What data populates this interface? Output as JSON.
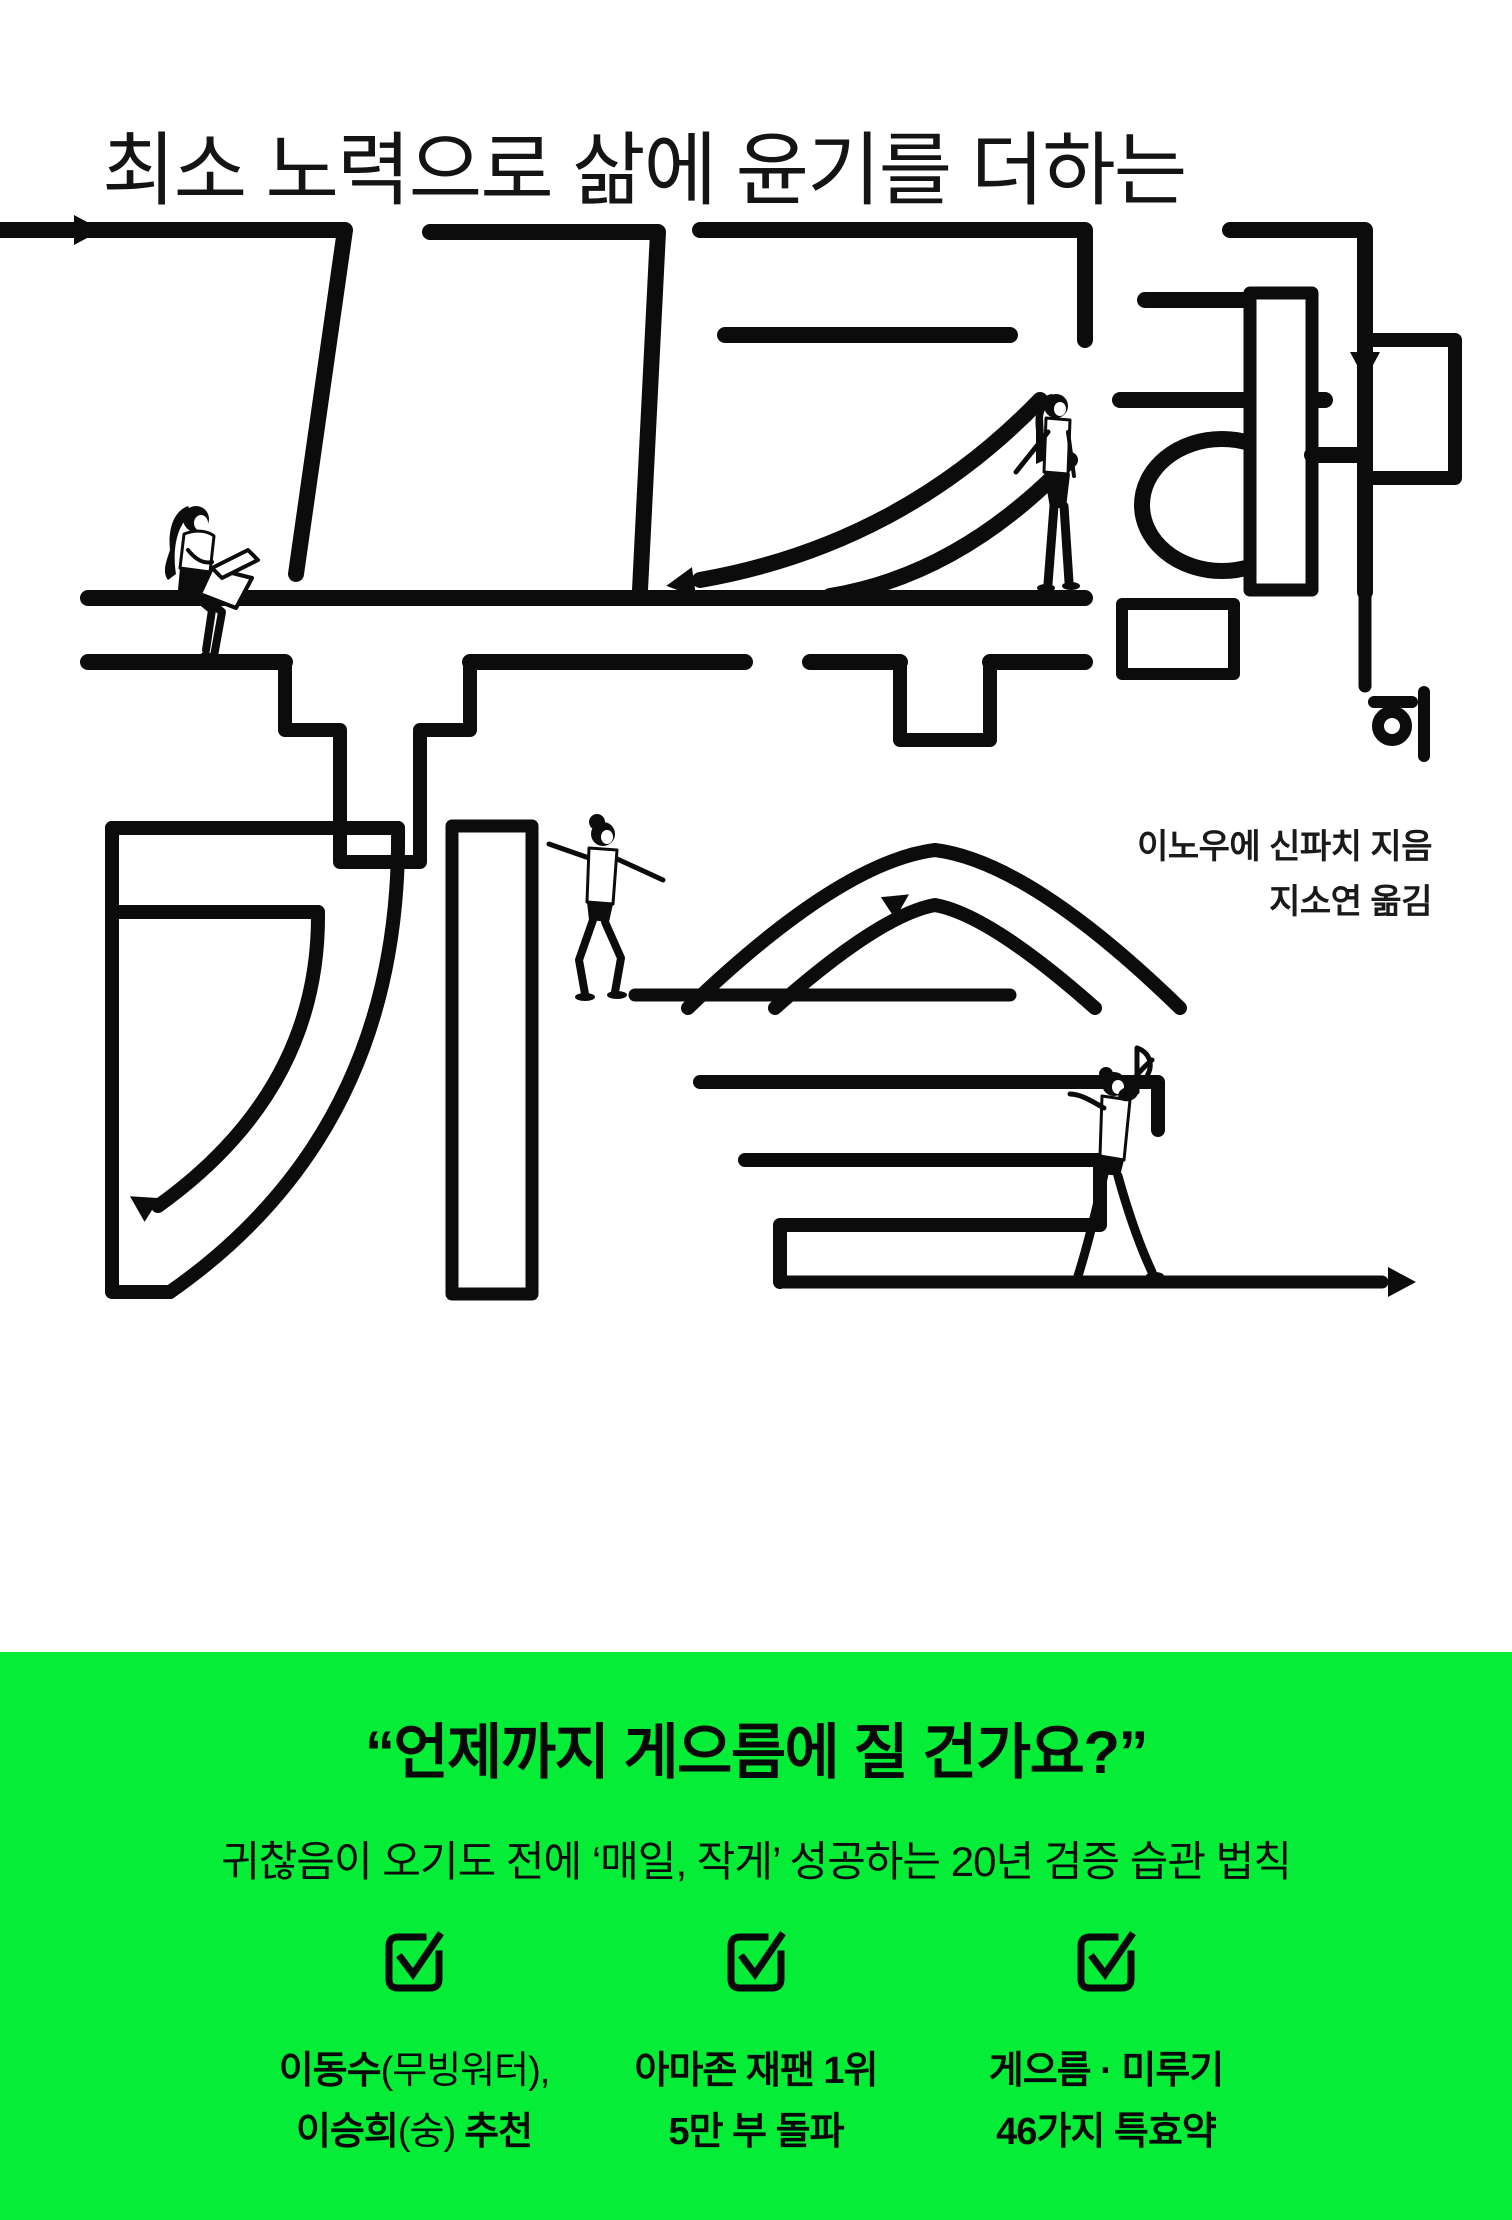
{
  "cover": {
    "tagline": "최소 노력으로 삶에 윤기를 더하는",
    "title": "꾸준함의 기술",
    "title_main": "꾸준함",
    "title_particle": "의",
    "title_sub": "기술",
    "author_credit": "이노우에 신파치 지음",
    "translator_credit": "지소연 옮김",
    "art": {
      "style": "black maze line-art typography with arrows",
      "figures": [
        "sitting-woman-with-laptop",
        "standing-woman",
        "walking-woman",
        "dancing-woman",
        "eighth-note"
      ]
    }
  },
  "green_band": {
    "bg_color": "#05ED37",
    "quote": "“언제까지 게으름에 질 건가요?”",
    "subtitle": "귀찮음이 오기도 전에 ‘매일, 작게’ 성공하는 20년 검증 습관 법칙",
    "checks": [
      {
        "line1_main": "이동수",
        "line1_paren": "(무빙워터),",
        "line2_main": "이승희",
        "line2_paren": "(숭)",
        "line2_suffix": "추천"
      },
      {
        "line1_main": "아마존 재팬 1위",
        "line1_paren": "",
        "line2_main": "5만 부 돌파",
        "line2_paren": "",
        "line2_suffix": ""
      },
      {
        "line1_main": "게으름 · 미루기",
        "line1_paren": "",
        "line2_main": "46가지 특효약",
        "line2_paren": "",
        "line2_suffix": ""
      }
    ]
  }
}
